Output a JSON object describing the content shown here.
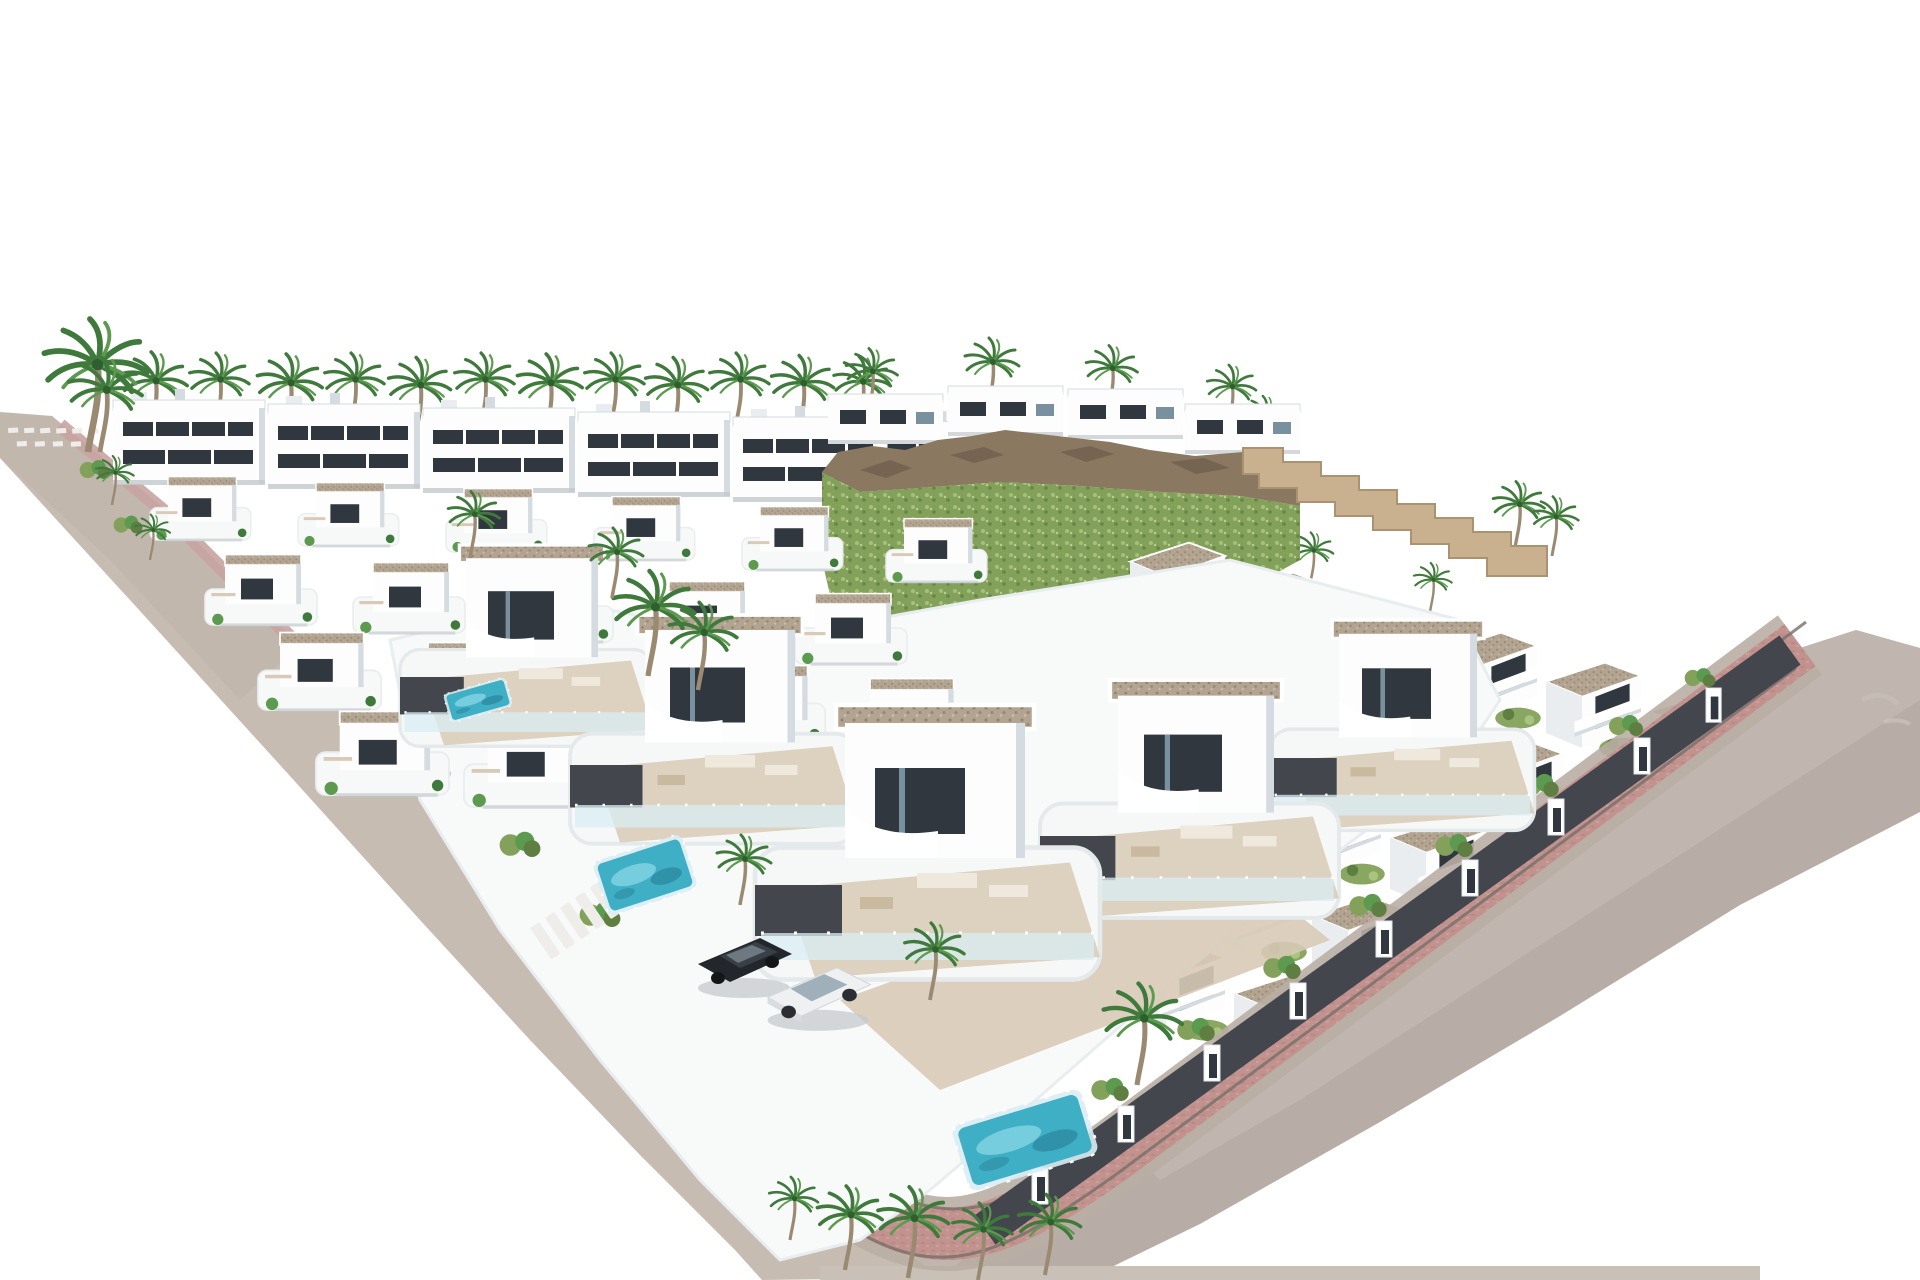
{
  "meta": {
    "scene_type": "3d-architectural-render",
    "description": "Aerial 3D render of a modern white villa development: rows of flat-roofed villas with gravel roofs, turquoise pools, palm trees, a rocky green hillside with stepped stone retaining wall, apartment blocks at the back, curved grey streets with pink pavements and a large grey embankment falling to the bottom-right, all on a plain white background",
    "visible_text": "none",
    "people_visible": "tiny figures on terraces",
    "vehicles": [
      "dark SUV",
      "white pickup"
    ]
  },
  "palette": {
    "bg": "#ffffff",
    "roadGray": "#c7bcb2",
    "roadGrayDark": "#b9aea4",
    "curbPink": "#c8a3a1",
    "brick": "#c2928f",
    "brickEdge": "#776f68",
    "sidewalkWhite": "#efedea",
    "slopeGray": "#b7ada6",
    "slopeLight": "#c6bdb5",
    "groundStrip": "#c9c0b8",
    "buildingWhite": "#fdfdfd",
    "facadeShade": "#e9edf0",
    "deepShade": "#d5dce1",
    "windowDark": "#31373e",
    "glassBlue": "#79919e",
    "roofGravel": "#b3a491",
    "roofDot": "#8f8170",
    "charcoal": "#43474d",
    "stoneWall": "#c9b190",
    "stoneEdge": "#ab9271",
    "rockBrown": "#8a7861",
    "rockDark": "#6e5f4e",
    "scrubGreen": "#83a15a",
    "scrubLight": "#a9c47f",
    "scrubDark": "#5e7f41",
    "palmGreen": "#3f7a3c",
    "palmLight": "#5c9a50",
    "trunk": "#9b8a72",
    "poolWater": "#3fafc5",
    "poolDeep": "#2d8ba0",
    "poolLight": "#85d4e2",
    "glassFence": "#d9edf3",
    "terraceTan": "#d8cab6",
    "furniture": "#efe8dc",
    "carDark": "#23272c",
    "carDarkTop": "#3a4047",
    "carWhite": "#eef0f1",
    "carGlass": "#9fb0ba",
    "shadow": "#c2c8cc"
  },
  "scene": {
    "apartments": [
      {
        "x": 113,
        "y": 392,
        "s": 1
      },
      {
        "x": 268,
        "y": 396,
        "s": 1
      },
      {
        "x": 423,
        "y": 400,
        "s": 1
      },
      {
        "x": 578,
        "y": 404,
        "s": 1
      },
      {
        "x": 733,
        "y": 409,
        "s": 1
      },
      {
        "x": 878,
        "y": 414,
        "s": 0.95
      }
    ],
    "hilltop_houses": [
      {
        "x": 828,
        "y": 388,
        "s": 1
      },
      {
        "x": 948,
        "y": 380,
        "s": 1
      },
      {
        "x": 1068,
        "y": 383,
        "s": 1
      },
      {
        "x": 1185,
        "y": 398,
        "s": 1
      }
    ],
    "villas_left": [
      {
        "x": 150,
        "y": 468,
        "s": 0.72
      },
      {
        "x": 298,
        "y": 474,
        "s": 0.72
      },
      {
        "x": 446,
        "y": 480,
        "s": 0.72
      },
      {
        "x": 594,
        "y": 488,
        "s": 0.72
      },
      {
        "x": 742,
        "y": 498,
        "s": 0.72
      },
      {
        "x": 886,
        "y": 510,
        "s": 0.72
      },
      {
        "x": 205,
        "y": 545,
        "s": 0.8
      },
      {
        "x": 353,
        "y": 553,
        "s": 0.8
      },
      {
        "x": 501,
        "y": 562,
        "s": 0.8
      },
      {
        "x": 649,
        "y": 572,
        "s": 0.8
      },
      {
        "x": 795,
        "y": 584,
        "s": 0.8
      },
      {
        "x": 258,
        "y": 622,
        "s": 0.88
      },
      {
        "x": 406,
        "y": 632,
        "s": 0.88
      },
      {
        "x": 554,
        "y": 643,
        "s": 0.88
      },
      {
        "x": 702,
        "y": 655,
        "s": 0.88
      },
      {
        "x": 848,
        "y": 668,
        "s": 0.88
      },
      {
        "x": 316,
        "y": 700,
        "s": 0.95
      },
      {
        "x": 464,
        "y": 712,
        "s": 0.95
      },
      {
        "x": 612,
        "y": 726,
        "s": 0.95
      }
    ],
    "villas_right": [
      {
        "x": 1130,
        "y": 535,
        "s": 0.95
      },
      {
        "x": 1234,
        "y": 565,
        "s": 0.95
      },
      {
        "x": 1338,
        "y": 595,
        "s": 0.95
      },
      {
        "x": 1442,
        "y": 625,
        "s": 0.95
      },
      {
        "x": 1546,
        "y": 655,
        "s": 0.95
      },
      {
        "x": 1650,
        "y": 685,
        "s": 0.95
      },
      {
        "x": 1052,
        "y": 613,
        "s": 0.95
      },
      {
        "x": 1156,
        "y": 643,
        "s": 0.95
      },
      {
        "x": 1260,
        "y": 673,
        "s": 0.95
      },
      {
        "x": 1364,
        "y": 703,
        "s": 0.95
      },
      {
        "x": 1468,
        "y": 733,
        "s": 0.95
      },
      {
        "x": 1572,
        "y": 763,
        "s": 0.95
      },
      {
        "x": 974,
        "y": 691,
        "s": 0.95
      },
      {
        "x": 1078,
        "y": 721,
        "s": 0.95
      },
      {
        "x": 1182,
        "y": 751,
        "s": 0.95
      },
      {
        "x": 1286,
        "y": 781,
        "s": 0.95
      },
      {
        "x": 1390,
        "y": 811,
        "s": 0.95
      },
      {
        "x": 1494,
        "y": 841,
        "s": 0.95
      },
      {
        "x": 896,
        "y": 769,
        "s": 0.95
      },
      {
        "x": 1000,
        "y": 799,
        "s": 0.95
      },
      {
        "x": 1104,
        "y": 829,
        "s": 0.95
      },
      {
        "x": 1208,
        "y": 859,
        "s": 0.95
      },
      {
        "x": 1312,
        "y": 889,
        "s": 0.95
      },
      {
        "x": 818,
        "y": 847,
        "s": 0.95
      },
      {
        "x": 922,
        "y": 877,
        "s": 0.95
      },
      {
        "x": 1026,
        "y": 907,
        "s": 0.95
      },
      {
        "x": 1130,
        "y": 937,
        "s": 0.95
      },
      {
        "x": 1234,
        "y": 967,
        "s": 0.95
      }
    ],
    "foreground_villas": [
      {
        "x": 1270,
        "y": 620,
        "s": 1.15
      },
      {
        "x": 1040,
        "y": 680,
        "s": 1.3
      },
      {
        "x": 400,
        "y": 545,
        "s": 1.1
      },
      {
        "x": 570,
        "y": 615,
        "s": 1.25
      },
      {
        "x": 755,
        "y": 705,
        "s": 1.5
      }
    ],
    "palms": [
      {
        "x": 150,
        "y": 436,
        "s": 1.2
      },
      {
        "x": 215,
        "y": 430,
        "s": 1.1
      },
      {
        "x": 285,
        "y": 438,
        "s": 1.2
      },
      {
        "x": 350,
        "y": 430,
        "s": 1.1
      },
      {
        "x": 415,
        "y": 438,
        "s": 1.15
      },
      {
        "x": 480,
        "y": 430,
        "s": 1.1
      },
      {
        "x": 545,
        "y": 438,
        "s": 1.2
      },
      {
        "x": 610,
        "y": 430,
        "s": 1.1
      },
      {
        "x": 672,
        "y": 438,
        "s": 1.15
      },
      {
        "x": 735,
        "y": 430,
        "s": 1.1
      },
      {
        "x": 798,
        "y": 436,
        "s": 1.15
      },
      {
        "x": 858,
        "y": 430,
        "s": 1.05
      },
      {
        "x": 868,
        "y": 415,
        "s": 0.95
      },
      {
        "x": 988,
        "y": 408,
        "s": 1.0
      },
      {
        "x": 1108,
        "y": 412,
        "s": 0.95
      },
      {
        "x": 1228,
        "y": 428,
        "s": 0.9
      },
      {
        "x": 1262,
        "y": 452,
        "s": 0.8
      },
      {
        "x": 1515,
        "y": 548,
        "s": 0.95
      },
      {
        "x": 1552,
        "y": 556,
        "s": 0.85
      },
      {
        "x": 1185,
        "y": 548,
        "s": 0.8
      },
      {
        "x": 1310,
        "y": 585,
        "s": 0.75
      },
      {
        "x": 1430,
        "y": 612,
        "s": 0.7
      },
      {
        "x": 1005,
        "y": 688,
        "s": 0.7
      },
      {
        "x": 88,
        "y": 452,
        "s": 1.9
      },
      {
        "x": 100,
        "y": 452,
        "s": 1.35
      },
      {
        "x": 648,
        "y": 676,
        "s": 1.5
      },
      {
        "x": 698,
        "y": 690,
        "s": 1.25
      },
      {
        "x": 612,
        "y": 598,
        "s": 1.0
      },
      {
        "x": 470,
        "y": 558,
        "s": 0.95
      },
      {
        "x": 1137,
        "y": 1085,
        "s": 1.45
      },
      {
        "x": 930,
        "y": 1000,
        "s": 1.1
      },
      {
        "x": 740,
        "y": 905,
        "s": 1.0
      },
      {
        "x": 845,
        "y": 1270,
        "s": 1.2
      },
      {
        "x": 908,
        "y": 1278,
        "s": 1.3
      },
      {
        "x": 978,
        "y": 1280,
        "s": 1.1
      },
      {
        "x": 1045,
        "y": 1275,
        "s": 1.15
      },
      {
        "x": 790,
        "y": 1240,
        "s": 0.9
      },
      {
        "x": 112,
        "y": 505,
        "s": 0.7
      },
      {
        "x": 150,
        "y": 560,
        "s": 0.65
      }
    ],
    "shrubs": [
      {
        "x": 1025,
        "y": 1150,
        "s": 1.1
      },
      {
        "x": 1110,
        "y": 1090,
        "s": 1.1
      },
      {
        "x": 1196,
        "y": 1030,
        "s": 1.1
      },
      {
        "x": 1282,
        "y": 968,
        "s": 1.1
      },
      {
        "x": 1368,
        "y": 906,
        "s": 1.1
      },
      {
        "x": 1454,
        "y": 846,
        "s": 1.1
      },
      {
        "x": 1540,
        "y": 786,
        "s": 1.1
      },
      {
        "x": 1626,
        "y": 726,
        "s": 1.0
      },
      {
        "x": 1700,
        "y": 678,
        "s": 0.9
      },
      {
        "x": 430,
        "y": 770,
        "s": 1.2
      },
      {
        "x": 520,
        "y": 845,
        "s": 1.2
      },
      {
        "x": 600,
        "y": 915,
        "s": 1.2
      },
      {
        "x": 420,
        "y": 680,
        "s": 1.0
      },
      {
        "x": 545,
        "y": 735,
        "s": 1.0
      },
      {
        "x": 95,
        "y": 470,
        "s": 0.9
      },
      {
        "x": 128,
        "y": 525,
        "s": 0.85
      }
    ],
    "wall_pillars": [
      {
        "x": 1032,
        "y": 1168,
        "s": 1
      },
      {
        "x": 1118,
        "y": 1106,
        "s": 1
      },
      {
        "x": 1204,
        "y": 1045,
        "s": 1
      },
      {
        "x": 1290,
        "y": 983,
        "s": 1
      },
      {
        "x": 1376,
        "y": 921,
        "s": 1
      },
      {
        "x": 1462,
        "y": 860,
        "s": 1
      },
      {
        "x": 1548,
        "y": 799,
        "s": 1
      },
      {
        "x": 1634,
        "y": 738,
        "s": 1
      },
      {
        "x": 1706,
        "y": 688,
        "s": 0.95
      }
    ],
    "pools": [
      {
        "x": 478,
        "y": 700,
        "r": -16,
        "sx": 0.62,
        "sy": 0.5
      },
      {
        "x": 645,
        "y": 875,
        "r": -18,
        "sx": 0.9,
        "sy": 0.95
      },
      {
        "x": 1025,
        "y": 1140,
        "r": -17,
        "sx": 1.3,
        "sy": 1.15
      }
    ],
    "cars_dark": [
      {
        "x": 744,
        "y": 962,
        "s": 1.0
      }
    ],
    "cars_white": [
      {
        "x": 818,
        "y": 993,
        "s": 1.05
      }
    ],
    "crosswalks": [
      {
        "x": 530,
        "y": 928,
        "r": -34,
        "s": 1
      }
    ],
    "dash_rows": [
      {
        "x": 8,
        "y": 428,
        "r": -3,
        "s": 1
      }
    ]
  }
}
